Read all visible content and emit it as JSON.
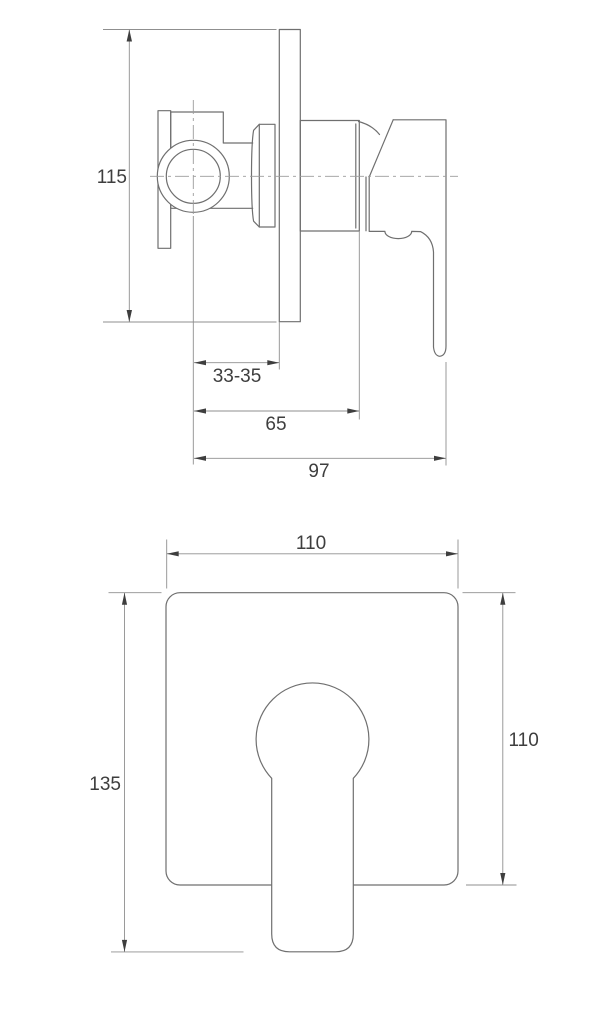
{
  "drawing": {
    "type": "technical-dimension-drawing",
    "subject": "concealed shower mixer valve, two orthographic views",
    "units": "mm",
    "colors": {
      "background": "#ffffff",
      "object_line": "#6f6f6f",
      "dimension_line": "#8f8f8f",
      "center_line": "#9c9c9c",
      "text_and_arrows": "#3e3e3e"
    },
    "side_view": {
      "labels": {
        "overall_height": "115",
        "center_to_wall_range": "33-35",
        "center_to_plate_face": "65",
        "center_to_handle_face": "97"
      }
    },
    "front_view": {
      "labels": {
        "plate_width": "110",
        "plate_height": "110",
        "overall_height_with_lever": "135"
      }
    }
  }
}
